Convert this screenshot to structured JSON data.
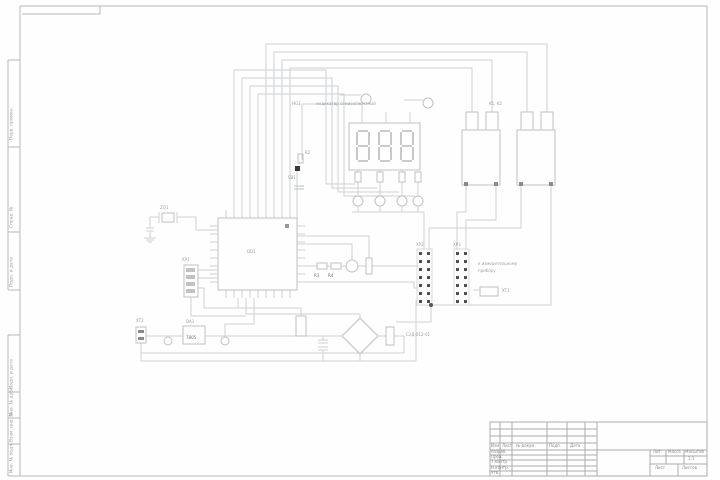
{
  "colors": {
    "frame_line": "#b6b8ba",
    "title_line": "#aaacae",
    "wire": "#ced0d2",
    "component": "#bfc1c3",
    "pin_dark": "#4d4d4d",
    "text_gray": "#9aa0a4",
    "text_dark": "#6e6e6e"
  },
  "frame": {
    "left_labels": [
      "Перв. примен.",
      "Справ. №",
      "Подп. и дата",
      "Подп. и дата",
      "Инв. № дубл.",
      "Взам. инв. №",
      "Инв. № подл."
    ]
  },
  "title_block": {
    "change_cols": [
      "Изм.",
      "Лист",
      "№ докум.",
      "Подп.",
      "Дата"
    ],
    "role_rows": [
      "Разраб.",
      "Пров.",
      "Т.контр.",
      "Н.контр.",
      "Утв."
    ],
    "attr_headers": [
      "Лит.",
      "Масса",
      "Масштаб"
    ],
    "scale": "1:1",
    "sheet_label": "Лист",
    "sheets_label": "Листов"
  },
  "schematic": {
    "mcu": "DD1",
    "display": {
      "designator": "HG1",
      "note": "индикатор семисегментный"
    },
    "relays": "K1, K2",
    "button": {
      "r": "R2",
      "sb": "SB1"
    },
    "resistors": {
      "r3": "R3",
      "r4": "R4"
    },
    "crystal": "ZQ1",
    "connectors": {
      "xp1": "XP1",
      "xp2": "XP2",
      "xp3": "XP3",
      "xt1": "XT1",
      "xt2": "XT2"
    },
    "regulator": {
      "designator": "DA1",
      "part": "7805"
    },
    "notes": {
      "to_device_1": "к измерительному",
      "to_device_2": "прибору",
      "part_no": "С2Д-012-01"
    }
  }
}
